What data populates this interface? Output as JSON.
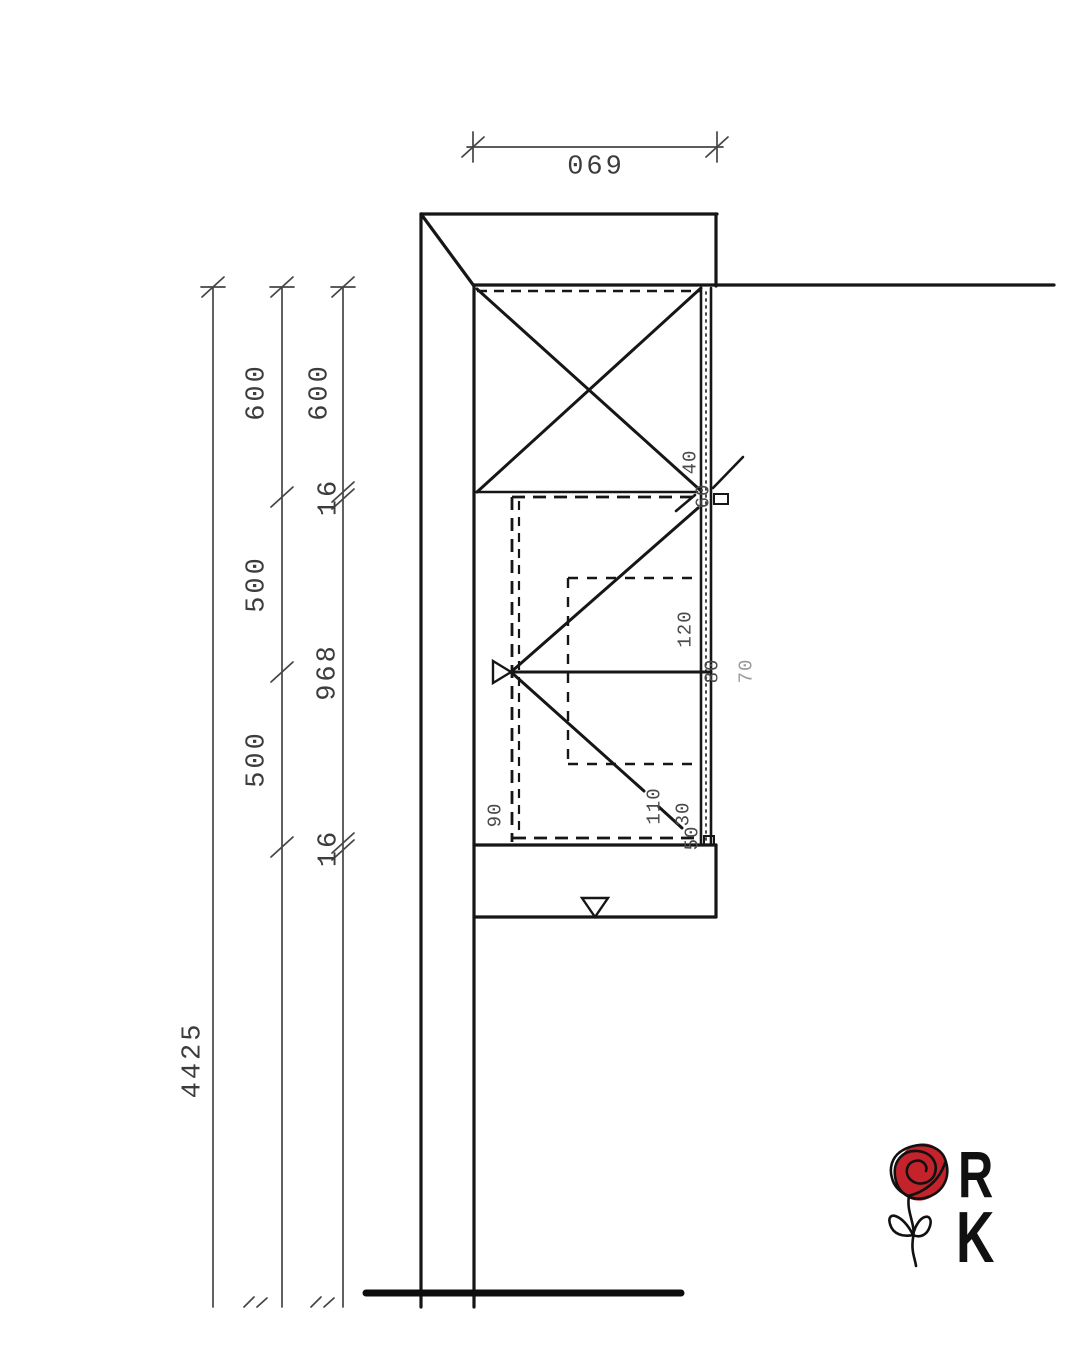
{
  "drawing": {
    "type": "kitchen cabinet side elevation, technical CAD drawing",
    "line_color": "#161616",
    "dim_color": "#454545"
  },
  "dimensions": {
    "top_width": "069",
    "left_chain_inner": [
      "600",
      "16",
      "968",
      "16"
    ],
    "left_chain_middle": [
      "600",
      "500",
      "500"
    ],
    "overall_height": "4425",
    "detail_labels": [
      "40",
      "60",
      "120",
      "80",
      "70",
      "90",
      "110",
      "30",
      "50"
    ]
  },
  "labels": [
    {
      "text": "069",
      "x": 596,
      "y": 168,
      "rot": false,
      "cls": "dim-big",
      "name": "dim-top-width"
    },
    {
      "text": "600",
      "x": 258,
      "y": 392,
      "rot": true,
      "cls": "dim-big",
      "name": "dim-600-middle"
    },
    {
      "text": "600",
      "x": 321,
      "y": 392,
      "rot": true,
      "cls": "dim-big",
      "name": "dim-600-inner"
    },
    {
      "text": "16",
      "x": 330,
      "y": 497,
      "rot": true,
      "cls": "dim-big",
      "name": "dim-16-upper"
    },
    {
      "text": "500",
      "x": 258,
      "y": 584,
      "rot": true,
      "cls": "dim-big",
      "name": "dim-500-upper"
    },
    {
      "text": "968",
      "x": 329,
      "y": 672,
      "rot": true,
      "cls": "dim-big",
      "name": "dim-968"
    },
    {
      "text": "500",
      "x": 258,
      "y": 759,
      "rot": true,
      "cls": "dim-big",
      "name": "dim-500-lower"
    },
    {
      "text": "16",
      "x": 330,
      "y": 848,
      "rot": true,
      "cls": "dim-big",
      "name": "dim-16-lower"
    },
    {
      "text": "4425",
      "x": 194,
      "y": 1060,
      "rot": true,
      "cls": "dim-big",
      "name": "dim-4425-total"
    },
    {
      "text": "40",
      "x": 691,
      "y": 462,
      "rot": true,
      "cls": "dim-small",
      "name": "dim-40"
    },
    {
      "text": "60",
      "x": 704,
      "y": 496,
      "rot": true,
      "cls": "dim-small",
      "name": "dim-60"
    },
    {
      "text": "120",
      "x": 686,
      "y": 629,
      "rot": true,
      "cls": "dim-small",
      "name": "dim-120"
    },
    {
      "text": "80",
      "x": 713,
      "y": 671,
      "rot": true,
      "cls": "dim-small",
      "name": "dim-80"
    },
    {
      "text": "70",
      "x": 747,
      "y": 671,
      "rot": true,
      "cls": "dim-small dim-faint",
      "name": "dim-70"
    },
    {
      "text": "90",
      "x": 496,
      "y": 815,
      "rot": true,
      "cls": "dim-small",
      "name": "dim-90"
    },
    {
      "text": "110",
      "x": 655,
      "y": 806,
      "rot": true,
      "cls": "dim-small",
      "name": "dim-110"
    },
    {
      "text": "30",
      "x": 684,
      "y": 814,
      "rot": true,
      "cls": "dim-small",
      "name": "dim-30"
    },
    {
      "text": "50",
      "x": 693,
      "y": 838,
      "rot": true,
      "cls": "dim-small",
      "name": "dim-50"
    }
  ],
  "logo": {
    "letters": {
      "first": "R",
      "second": "K"
    },
    "rose_color": "#c4232b",
    "letter_color": "#111111"
  }
}
